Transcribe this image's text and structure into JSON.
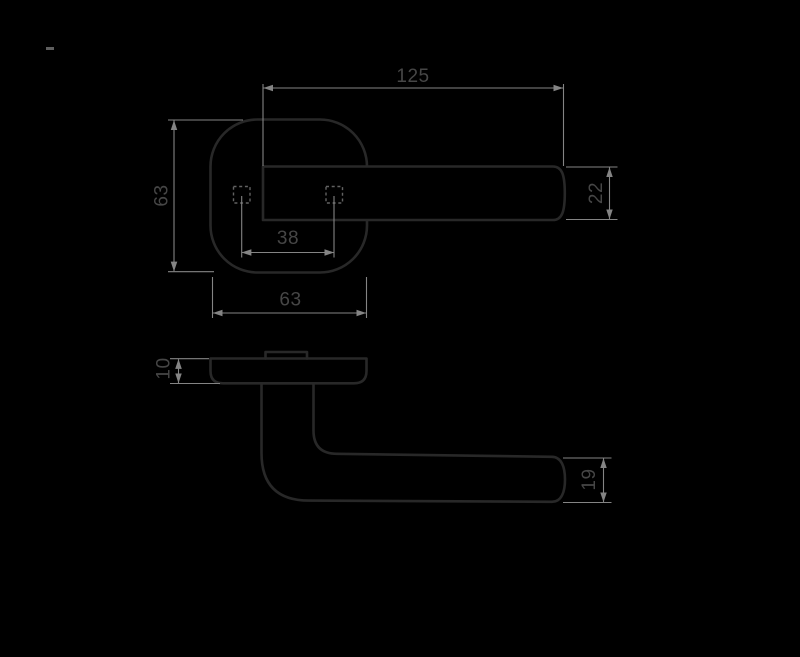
{
  "drawing": {
    "type": "technical-drawing",
    "subject": "lever door handle on square rosette",
    "views": {
      "top": "plan view",
      "side": "profile view"
    }
  },
  "colors": {
    "background": "#000000",
    "outline": "#282828",
    "dim_line": "#848484",
    "hidden_line": "#626262",
    "dim_text": "#464646",
    "tick_mark": "#5f5f5f"
  },
  "dimensions": {
    "lever_length": "125",
    "rosette_height": "63",
    "hole_spacing": "38",
    "rosette_width": "63",
    "lever_width": "22",
    "rosette_thickness": "10",
    "grip_diameter": "19"
  }
}
